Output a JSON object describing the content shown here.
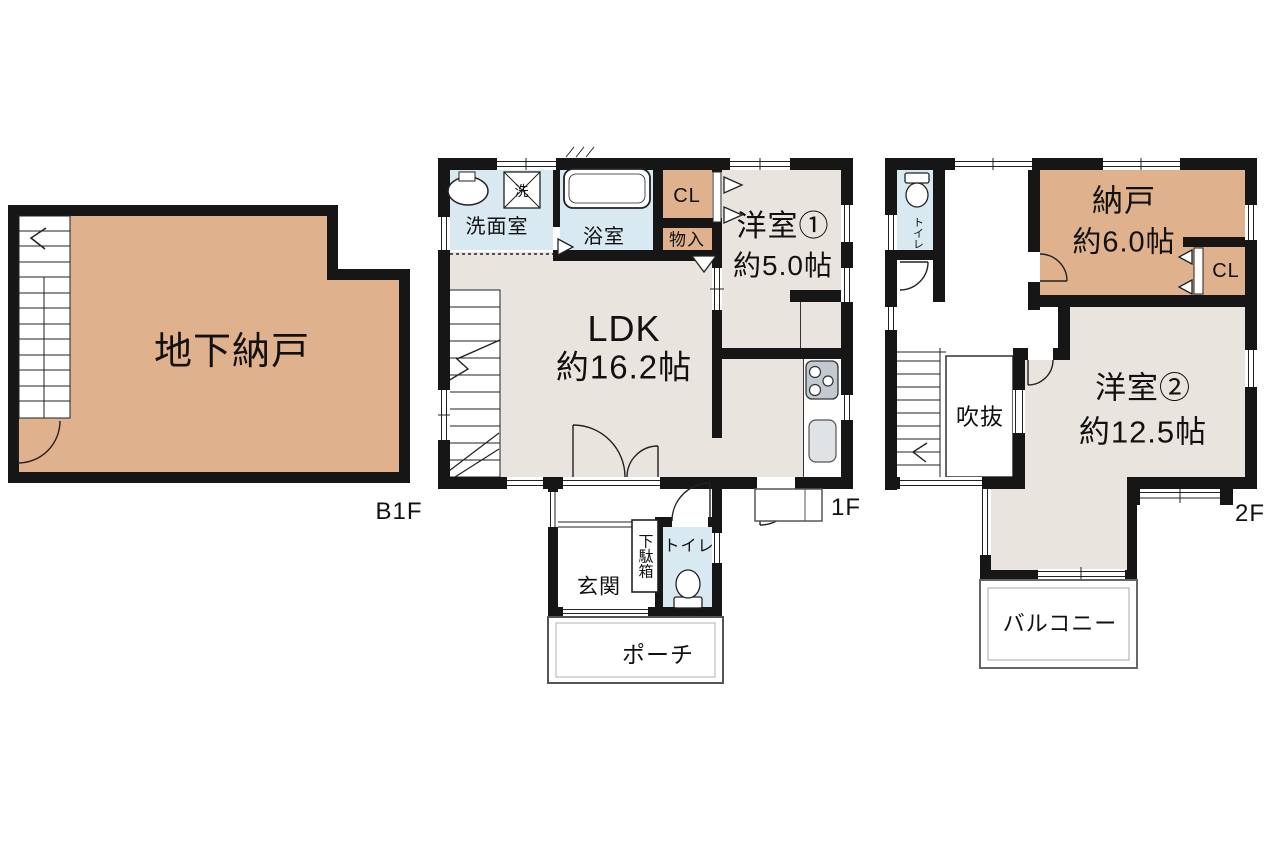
{
  "floors": {
    "b1f": {
      "label": "B1F",
      "rooms": {
        "underground_storage": "地下納戸"
      }
    },
    "f1": {
      "label": "1F",
      "rooms": {
        "washroom": "洗面室",
        "washer": "洗",
        "bathroom": "浴室",
        "closet": "CL",
        "storage_small": "物入",
        "bedroom1_name": "洋室①",
        "bedroom1_size": "約5.0帖",
        "ldk_name": "LDK",
        "ldk_size": "約16.2帖",
        "entrance": "玄関",
        "shoe_cabinet": "下駄箱",
        "toilet": "トイレ",
        "porch": "ポーチ"
      }
    },
    "f2": {
      "label": "2F",
      "rooms": {
        "toilet": "トイレ",
        "storage_name": "納戸",
        "storage_size": "約6.0帖",
        "closet": "CL",
        "void": "吹抜",
        "bedroom2_name": "洋室②",
        "bedroom2_size": "約12.5帖",
        "balcony": "バルコニー"
      }
    }
  },
  "icons": {
    "bathtub": "bathtub-icon",
    "washbasin": "sink-icon",
    "washing_machine": "washing-machine-icon",
    "stove": "stove-icon",
    "kitchen_sink": "kitchen-sink-icon",
    "toilet": "toilet-icon",
    "stairs": "stairs-icon",
    "door": "door-arc-icon",
    "window": "window-symbol"
  },
  "colors": {
    "wall": "#161616",
    "room_beige": "#e9e5de",
    "room_tan": "#dfb18c",
    "room_blue": "#d9e9f2",
    "fixture_gray": "#c3c9d0",
    "background": "#ffffff"
  }
}
